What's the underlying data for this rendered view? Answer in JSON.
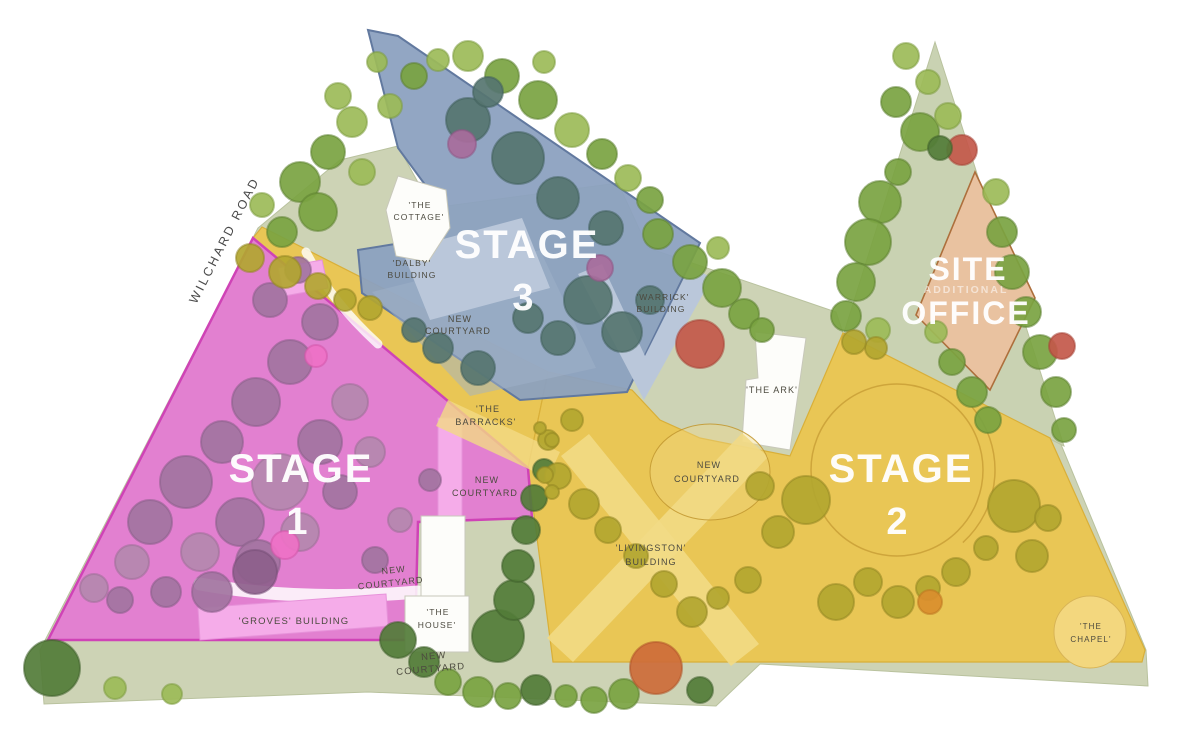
{
  "title": "Construction Staging Site Plan",
  "road_label": "WILCHARD ROAD",
  "stages": {
    "s1": {
      "word": "STAGE",
      "num": "1"
    },
    "s2": {
      "word": "STAGE",
      "num": "2"
    },
    "s3": {
      "word": "STAGE",
      "num": "3"
    }
  },
  "site_office": {
    "l1": "SITE",
    "l2": "ADDITIONAL",
    "l3": "OFFICE"
  },
  "labels": {
    "cottage_l1": "'THE",
    "cottage_l2": "COTTAGE'",
    "dalby_l1": "'DALBY'",
    "dalby_l2": "BUILDING",
    "courtyard_l1": "NEW",
    "courtyard_l2": "COURTYARD",
    "warrick_l1": "'WARRICK'",
    "warrick_l2": "BUILDING",
    "ark": "'THE ARK'",
    "barracks_l1": "'THE",
    "barracks_l2": "BARRACKS'",
    "livingston_l1": "'LIVINGSTON'",
    "livingston_l2": "BUILDING",
    "groves": "'GROVES' BUILDING",
    "house_l1": "'THE",
    "house_l2": "HOUSE'",
    "chapel_l1": "'THE",
    "chapel_l2": "CHAPEL'"
  },
  "palette": {
    "colors": {
      "sage": "#cdd3b5",
      "sage2": "#c9d2b2",
      "sageStroke": "#b9c29e",
      "stage1": "#e478d2",
      "stage1Stroke": "#cf43b6",
      "stage2": "#e9c655",
      "stage2Stroke": "#d9af38",
      "stage3": "#8ba0bf",
      "stage3Stroke": "#62799f",
      "office": "#e9c2a0",
      "officeStroke": "#ad6f3c",
      "bldgWhite": "#fdfdfa",
      "lightBlue": "#bac7da",
      "lightPink": "#f5ace9",
      "pathYellow": "#f2da85",
      "chapel": "#f3d77e",
      "ringStroke": "#c49a33",
      "ink": "#4c4a3f"
    },
    "trees": {
      "g1": [
        "#9cbb58",
        "#7d9c40"
      ],
      "g2": [
        "#7aa341",
        "#5d8230"
      ],
      "g3": [
        "#527c38",
        "#3f612b"
      ],
      "olive": [
        "#b2a630",
        "#938722"
      ],
      "teal": [
        "#567570",
        "#42605c"
      ],
      "plum": [
        "#a86d9c",
        "#8f5585"
      ],
      "purple": [
        "#a274a0",
        "#885e88"
      ],
      "purple2": [
        "#b488ae",
        "#9a7096"
      ],
      "purple3": [
        "#8d5f8b",
        "#774e77"
      ],
      "pinkT": [
        "#ee71c6",
        "#d455aa"
      ],
      "red": [
        "#c3584a",
        "#a84437"
      ],
      "orangeR": [
        "#cd6b3a",
        "#b05428"
      ],
      "orangeT": [
        "#d98e2e",
        "#bd7620"
      ]
    }
  },
  "trees": [
    [
      300,
      182,
      20,
      "g2"
    ],
    [
      328,
      152,
      17,
      "g2"
    ],
    [
      352,
      122,
      15,
      "g1"
    ],
    [
      338,
      96,
      13,
      "g1"
    ],
    [
      318,
      212,
      19,
      "g2"
    ],
    [
      282,
      232,
      15,
      "g2"
    ],
    [
      362,
      172,
      13,
      "g1"
    ],
    [
      390,
      106,
      12,
      "g1"
    ],
    [
      414,
      76,
      13,
      "g2"
    ],
    [
      438,
      60,
      11,
      "g1"
    ],
    [
      377,
      62,
      10,
      "g1"
    ],
    [
      262,
      205,
      12,
      "g1"
    ],
    [
      468,
      56,
      15,
      "g1"
    ],
    [
      502,
      76,
      17,
      "g2"
    ],
    [
      538,
      100,
      19,
      "g2"
    ],
    [
      572,
      130,
      17,
      "g1"
    ],
    [
      602,
      154,
      15,
      "g2"
    ],
    [
      628,
      178,
      13,
      "g1"
    ],
    [
      544,
      62,
      11,
      "g1"
    ],
    [
      650,
      200,
      13,
      "g2"
    ],
    [
      468,
      120,
      22,
      "teal"
    ],
    [
      518,
      158,
      26,
      "teal"
    ],
    [
      558,
      198,
      21,
      "teal"
    ],
    [
      606,
      228,
      17,
      "teal"
    ],
    [
      488,
      92,
      15,
      "teal"
    ],
    [
      588,
      300,
      24,
      "teal"
    ],
    [
      622,
      332,
      20,
      "teal"
    ],
    [
      558,
      338,
      17,
      "teal"
    ],
    [
      528,
      318,
      15,
      "teal"
    ],
    [
      438,
      348,
      15,
      "teal"
    ],
    [
      478,
      368,
      17,
      "teal"
    ],
    [
      414,
      330,
      12,
      "teal"
    ],
    [
      650,
      300,
      14,
      "teal"
    ],
    [
      462,
      144,
      14,
      "plum"
    ],
    [
      600,
      268,
      13,
      "plum"
    ],
    [
      658,
      234,
      15,
      "g2"
    ],
    [
      690,
      262,
      17,
      "g2"
    ],
    [
      722,
      288,
      19,
      "g2"
    ],
    [
      744,
      314,
      15,
      "g2"
    ],
    [
      718,
      248,
      11,
      "g1"
    ],
    [
      700,
      344,
      24,
      "red"
    ],
    [
      762,
      330,
      12,
      "g2"
    ],
    [
      906,
      56,
      13,
      "g1"
    ],
    [
      928,
      82,
      12,
      "g1"
    ],
    [
      896,
      102,
      15,
      "g2"
    ],
    [
      920,
      132,
      19,
      "g2"
    ],
    [
      948,
      116,
      13,
      "g1"
    ],
    [
      962,
      150,
      15,
      "red"
    ],
    [
      940,
      148,
      12,
      "g3"
    ],
    [
      898,
      172,
      13,
      "g2"
    ],
    [
      880,
      202,
      21,
      "g2"
    ],
    [
      868,
      242,
      23,
      "g2"
    ],
    [
      856,
      282,
      19,
      "g2"
    ],
    [
      846,
      316,
      15,
      "g2"
    ],
    [
      996,
      192,
      13,
      "g1"
    ],
    [
      1002,
      232,
      15,
      "g2"
    ],
    [
      1012,
      272,
      17,
      "g2"
    ],
    [
      1026,
      312,
      15,
      "g2"
    ],
    [
      1040,
      352,
      17,
      "g2"
    ],
    [
      1056,
      392,
      15,
      "g2"
    ],
    [
      1062,
      346,
      13,
      "red"
    ],
    [
      936,
      332,
      11,
      "g1"
    ],
    [
      952,
      362,
      13,
      "g2"
    ],
    [
      972,
      392,
      15,
      "g2"
    ],
    [
      988,
      420,
      13,
      "g2"
    ],
    [
      1064,
      430,
      12,
      "g2"
    ],
    [
      878,
      330,
      12,
      "g1"
    ],
    [
      150,
      522,
      22,
      "purple"
    ],
    [
      186,
      482,
      26,
      "purple"
    ],
    [
      222,
      442,
      21,
      "purple"
    ],
    [
      256,
      402,
      24,
      "purple"
    ],
    [
      290,
      362,
      22,
      "purple"
    ],
    [
      320,
      322,
      18,
      "purple"
    ],
    [
      200,
      552,
      19,
      "purple2"
    ],
    [
      240,
      522,
      24,
      "purple"
    ],
    [
      280,
      482,
      28,
      "purple2"
    ],
    [
      320,
      442,
      22,
      "purple"
    ],
    [
      350,
      402,
      18,
      "purple2"
    ],
    [
      132,
      562,
      17,
      "purple2"
    ],
    [
      166,
      592,
      15,
      "purple"
    ],
    [
      212,
      592,
      20,
      "purple"
    ],
    [
      258,
      562,
      22,
      "purple"
    ],
    [
      300,
      532,
      19,
      "purple2"
    ],
    [
      340,
      492,
      17,
      "purple"
    ],
    [
      370,
      452,
      15,
      "purple2"
    ],
    [
      120,
      600,
      13,
      "purple"
    ],
    [
      94,
      588,
      14,
      "purple2"
    ],
    [
      270,
      300,
      17,
      "purple"
    ],
    [
      298,
      270,
      13,
      "purple"
    ],
    [
      285,
      545,
      14,
      "pinkT"
    ],
    [
      316,
      356,
      11,
      "pinkT"
    ],
    [
      255,
      572,
      22,
      "purple3"
    ],
    [
      375,
      560,
      13,
      "purple"
    ],
    [
      400,
      520,
      12,
      "purple2"
    ],
    [
      430,
      480,
      11,
      "purple"
    ],
    [
      52,
      668,
      28,
      "g3"
    ],
    [
      115,
      688,
      11,
      "g1"
    ],
    [
      172,
      694,
      10,
      "g1"
    ],
    [
      398,
      640,
      18,
      "g3"
    ],
    [
      424,
      662,
      15,
      "g3"
    ],
    [
      448,
      682,
      13,
      "g2"
    ],
    [
      478,
      692,
      15,
      "g2"
    ],
    [
      508,
      696,
      13,
      "g2"
    ],
    [
      536,
      690,
      15,
      "g3"
    ],
    [
      566,
      696,
      11,
      "g2"
    ],
    [
      594,
      700,
      13,
      "g2"
    ],
    [
      624,
      694,
      15,
      "g2"
    ],
    [
      656,
      668,
      26,
      "orangeR"
    ],
    [
      700,
      690,
      13,
      "g3"
    ],
    [
      498,
      636,
      26,
      "g3"
    ],
    [
      514,
      600,
      20,
      "g3"
    ],
    [
      518,
      566,
      16,
      "g3"
    ],
    [
      526,
      530,
      14,
      "g3"
    ],
    [
      534,
      498,
      13,
      "g3"
    ],
    [
      544,
      470,
      11,
      "g3"
    ],
    [
      250,
      258,
      14,
      "olive"
    ],
    [
      285,
      272,
      16,
      "olive"
    ],
    [
      318,
      286,
      13,
      "olive"
    ],
    [
      345,
      300,
      11,
      "olive"
    ],
    [
      370,
      308,
      12,
      "olive"
    ],
    [
      558,
      476,
      13,
      "olive"
    ],
    [
      584,
      504,
      15,
      "olive"
    ],
    [
      608,
      530,
      13,
      "olive"
    ],
    [
      636,
      556,
      12,
      "olive"
    ],
    [
      664,
      584,
      13,
      "olive"
    ],
    [
      692,
      612,
      15,
      "olive"
    ],
    [
      718,
      598,
      11,
      "olive"
    ],
    [
      748,
      580,
      13,
      "olive"
    ],
    [
      806,
      500,
      24,
      "olive"
    ],
    [
      778,
      532,
      16,
      "olive"
    ],
    [
      836,
      602,
      18,
      "olive"
    ],
    [
      868,
      582,
      14,
      "olive"
    ],
    [
      898,
      602,
      16,
      "olive"
    ],
    [
      928,
      588,
      12,
      "olive"
    ],
    [
      956,
      572,
      14,
      "olive"
    ],
    [
      986,
      548,
      12,
      "olive"
    ],
    [
      1014,
      506,
      26,
      "olive"
    ],
    [
      1032,
      556,
      16,
      "olive"
    ],
    [
      1048,
      518,
      13,
      "olive"
    ],
    [
      930,
      602,
      12,
      "orangeT"
    ],
    [
      572,
      420,
      11,
      "olive"
    ],
    [
      548,
      440,
      10,
      "olive"
    ],
    [
      760,
      486,
      14,
      "olive"
    ],
    [
      876,
      348,
      11,
      "olive"
    ],
    [
      854,
      342,
      12,
      "olive"
    ],
    [
      540,
      428,
      6,
      "olive"
    ],
    [
      552,
      440,
      7,
      "olive"
    ],
    [
      545,
      475,
      8,
      "olive"
    ],
    [
      552,
      492,
      7,
      "olive"
    ]
  ]
}
